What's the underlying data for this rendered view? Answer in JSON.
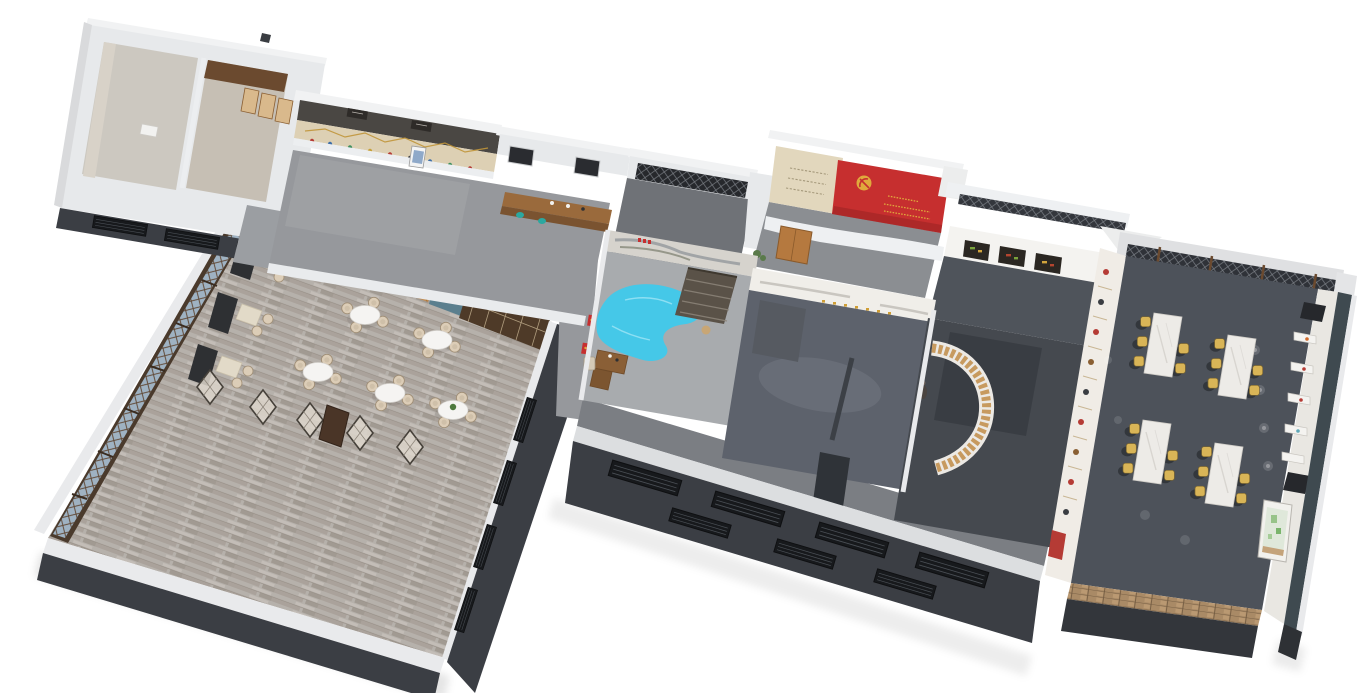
{
  "scene": {
    "description": "3D axonometric cutaway floor-plan rendering of a Chinese restaurant and party-culture exhibition complex on a white background",
    "canvas": {
      "width": 1357,
      "height": 693
    },
    "background": "#ffffff"
  },
  "palette": {
    "bg": "#ffffff",
    "wallTop": "#eff0f2",
    "wallFace": "#e7e9eb",
    "wallMid": "#c6c8cb",
    "wallDark": "#3b3e44",
    "wallDarker": "#26282c",
    "headerWood": "#4a4743",
    "woodDark": "#6b4a2f",
    "woodDoor": "#4e3a28",
    "woodMid": "#9a6a3c",
    "woodLight": "#d9b98c",
    "honeycomb": "#c08c52",
    "beigeWall": "#e2d7bd",
    "timelineBand": "#ddd0b4",
    "floorGallery": "#96989c",
    "floorClerestory": "#6f7277",
    "floorRedRoom": "#8b8e92",
    "floorCharcoal": "#4f545b",
    "floorSlateBlue": "#5d626c",
    "floorPale": "#a8abae",
    "floorCurve": "#45494f",
    "floorDining": "#4d525a",
    "floorCorridor": "#7b7e83",
    "floorPlank": "#b6b1ab",
    "lobby": "#9b9ea2",
    "bannerRed": "#c62f2f",
    "gold": "#e0a93c",
    "poolBlue": "#45c8e8",
    "tealChair": "#2ba8a0",
    "tealWall": "#5b7f8e",
    "tealOuter": "#3f4a50",
    "chairYellow": "#d9b557",
    "rattan": "#dccdb7",
    "benchDark": "#2e3033",
    "boothTable": "#e2dac8",
    "brick": "#a98a66",
    "glass": "#9fb2c2",
    "plantGreen": "#4e7a3e",
    "canopy": "#f4f3f0",
    "marbleTable": "#edebe7",
    "mapGreen": "#dfe8da",
    "deskWood": "#8a5f36",
    "pavilionRoof": "#5a5248"
  },
  "rooms": [
    {
      "id": "main-dining-hall",
      "label": "Main dining hall with round tables and booth seating"
    },
    {
      "id": "restrooms",
      "label": "Restroom block with stalls"
    },
    {
      "id": "exhibition-gallery",
      "label": "Long exhibition gallery with timeline wall"
    },
    {
      "id": "service-counter",
      "label": "Service counter / tea bar"
    },
    {
      "id": "clerestory-room",
      "label": "Room with dark lattice clerestory windows"
    },
    {
      "id": "banner-exhibition-hall",
      "label": "Party-culture hall with red emblem banner"
    },
    {
      "id": "food-display-corridor",
      "label": "Corridor with sculpted food-display canopy"
    },
    {
      "id": "water-feature-room",
      "label": "Room with free-form blue water feature, pavilion and desk"
    },
    {
      "id": "calligraphy-room",
      "label": "Exhibition room with gold calligraphy wall"
    },
    {
      "id": "curved-display-room",
      "label": "Room with curved timber display wall"
    },
    {
      "id": "south-corridor",
      "label": "South corridor along dark louvered facade"
    },
    {
      "id": "private-dining-hall",
      "label": "Banquet hall with marble tables and yellow chairs"
    }
  ],
  "furniture": {
    "round_tables": 5,
    "booth_units": 3,
    "folding_screens": 5,
    "banquet_tables": 4,
    "chairs_per_banquet_table": 6,
    "display_plates": 9,
    "display_panels": 5,
    "facade_louvers": 7
  },
  "banner": {
    "color_key": "bannerRed",
    "emblem": "gold party emblem (hammer and sickle)",
    "has_small_gold_text": true
  },
  "pool": {
    "color_key": "poolBlue"
  }
}
